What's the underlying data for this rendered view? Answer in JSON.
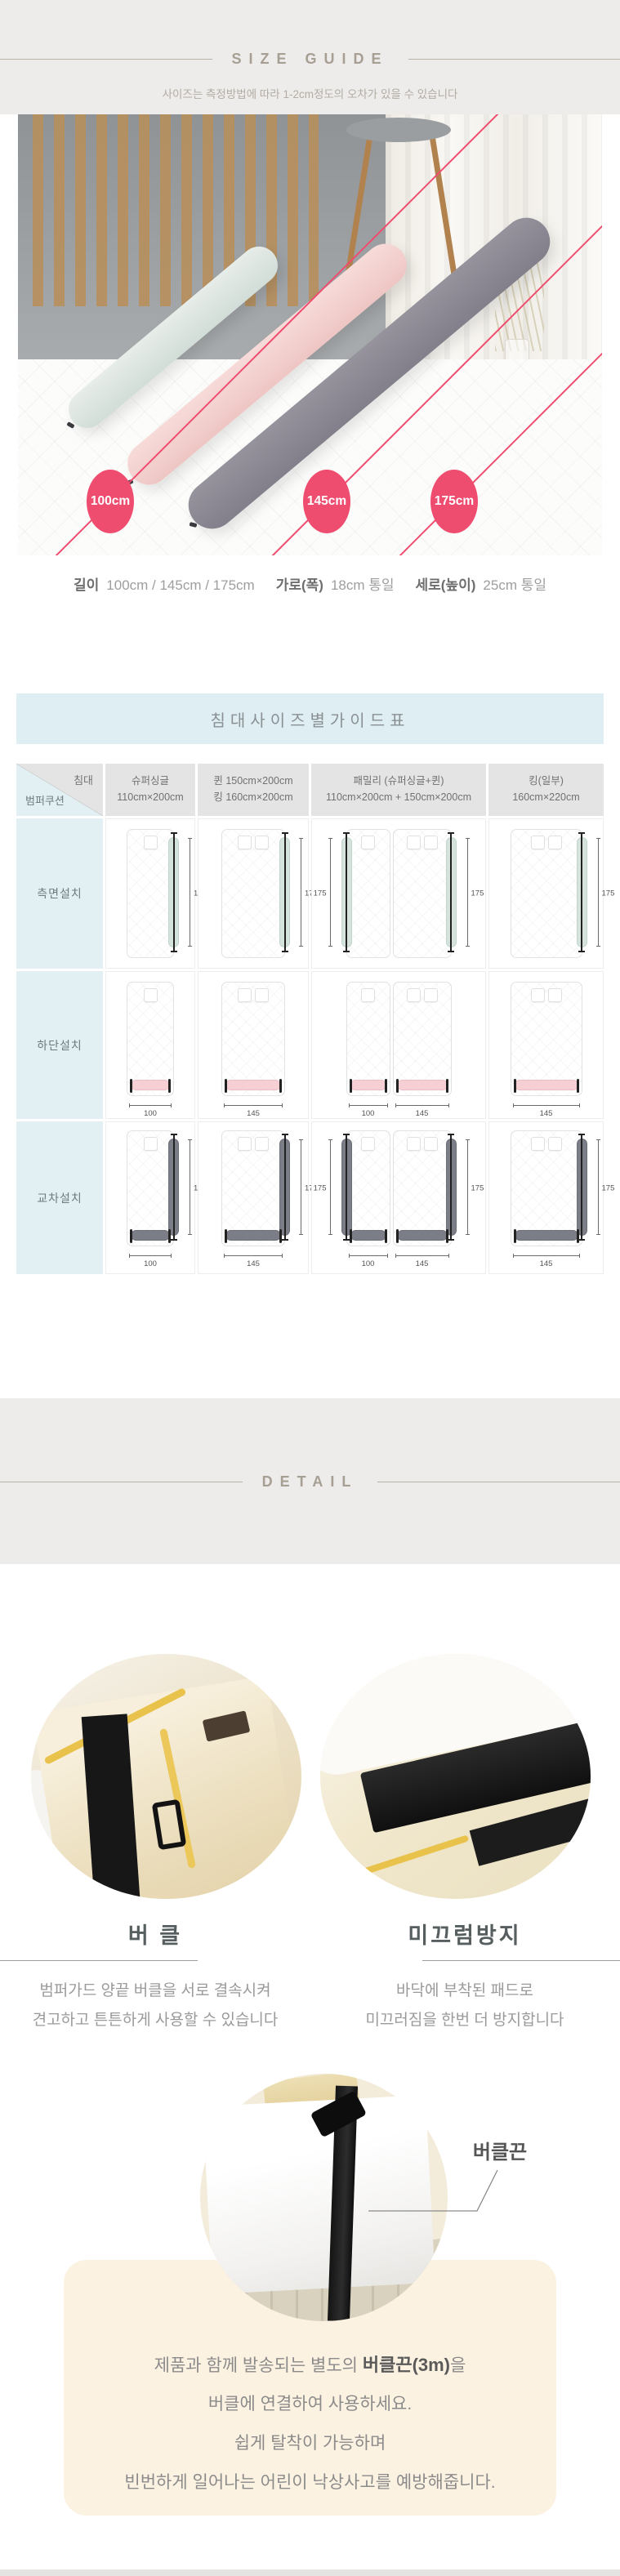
{
  "size_guide": {
    "title": "SIZE GUIDE",
    "subtitle": "사이즈는 측정방법에 따라 1-2cm정도의 오차가 있을 수 있습니다"
  },
  "photo": {
    "badges": [
      "100cm",
      "145cm",
      "175cm"
    ]
  },
  "specs": [
    {
      "label": "길이",
      "value": "100cm / 145cm / 175cm"
    },
    {
      "label": "가로(폭)",
      "value": "18cm 통일"
    },
    {
      "label": "세로(높이)",
      "value": "25cm 통일"
    }
  ],
  "size_table": {
    "title": "침대사이즈별가이드표",
    "corner": {
      "top": "침대",
      "bottom": "범퍼쿠션"
    },
    "columns": [
      {
        "lines": [
          "슈퍼싱글",
          "110cm×200cm"
        ]
      },
      {
        "lines": [
          "퀸 150cm×200cm",
          "킹 160cm×200cm"
        ]
      },
      {
        "lines": [
          "패밀리 (슈퍼싱글+퀸)",
          "110cm×200cm + 150cm×200cm"
        ]
      },
      {
        "lines": [
          "킹(일부)",
          "160cm×220cm"
        ]
      }
    ],
    "rows": [
      {
        "label": "측면설치",
        "bumper": "mint",
        "cells": [
          {
            "beds": [
              {
                "pillows": 1,
                "side": "right",
                "len": "175"
              }
            ]
          },
          {
            "beds": [
              {
                "pillows": 2,
                "side": "right",
                "len": "175"
              }
            ]
          },
          {
            "beds": [
              {
                "pillows": 1,
                "side": "left",
                "len": "175"
              },
              {
                "pillows": 2,
                "side": "right",
                "len": "175"
              }
            ]
          },
          {
            "beds": [
              {
                "pillows": 2,
                "side": "right",
                "len": "175"
              }
            ]
          }
        ]
      },
      {
        "label": "하단설치",
        "bumper": "pink",
        "cells": [
          {
            "beds": [
              {
                "pillows": 1,
                "bottom": "100"
              }
            ]
          },
          {
            "beds": [
              {
                "pillows": 2,
                "bottom": "145"
              }
            ]
          },
          {
            "beds": [
              {
                "pillows": 1,
                "bottom": "100"
              },
              {
                "pillows": 2,
                "bottom": "145"
              }
            ]
          },
          {
            "beds": [
              {
                "pillows": 2,
                "bottom": "145"
              }
            ]
          }
        ]
      },
      {
        "label": "교차설치",
        "bumper": "gray",
        "cells": [
          {
            "beds": [
              {
                "pillows": 1,
                "side": "right",
                "len": "175",
                "bottom": "100"
              }
            ]
          },
          {
            "beds": [
              {
                "pillows": 2,
                "side": "right",
                "len": "175",
                "bottom": "145"
              }
            ]
          },
          {
            "beds": [
              {
                "pillows": 1,
                "side": "left",
                "len": "175",
                "bottom": "100"
              },
              {
                "pillows": 2,
                "side": "right",
                "len": "175",
                "bottom": "145"
              }
            ]
          },
          {
            "beds": [
              {
                "pillows": 2,
                "side": "right",
                "len": "175",
                "bottom": "145"
              }
            ]
          }
        ]
      }
    ]
  },
  "detail": {
    "title": "DETAIL",
    "features": [
      {
        "title": "버 클",
        "lines": [
          "범퍼가드 양끝 버클을 서로 결속시켜",
          "견고하고 튼튼하게 사용할 수 있습니다"
        ]
      },
      {
        "title": "미끄럼방지",
        "lines": [
          "바닥에 부착된 패드로",
          "미끄러짐을 한번 더 방지합니다"
        ]
      }
    ],
    "strap_label": "버클끈",
    "note_lines": [
      [
        {
          "t": "제품과 함께 발송되는 별도의 "
        },
        {
          "t": "버클끈(3m)",
          "b": true
        },
        {
          "t": "을"
        }
      ],
      [
        {
          "t": "버클에 연결하여 사용하세요."
        }
      ],
      [
        {
          "t": "쉽게 탈착이 가능하며"
        }
      ],
      [
        {
          "t": "빈번하게 일어나는 어린이 낙상사고를 예방해줍니다."
        }
      ]
    ]
  },
  "colors": {
    "accent": "#ef4d70",
    "mint_bumper": "#d6e3dd",
    "pink_bumper": "#f6cfd4",
    "gray_bumper": "#7b7d87",
    "band_bg": "#edecea",
    "blue_cell": "#e2f0f4",
    "header_cell": "#e4e4e4",
    "title_bar": "#dfeef2",
    "note_bg": "#fcf2e2"
  }
}
